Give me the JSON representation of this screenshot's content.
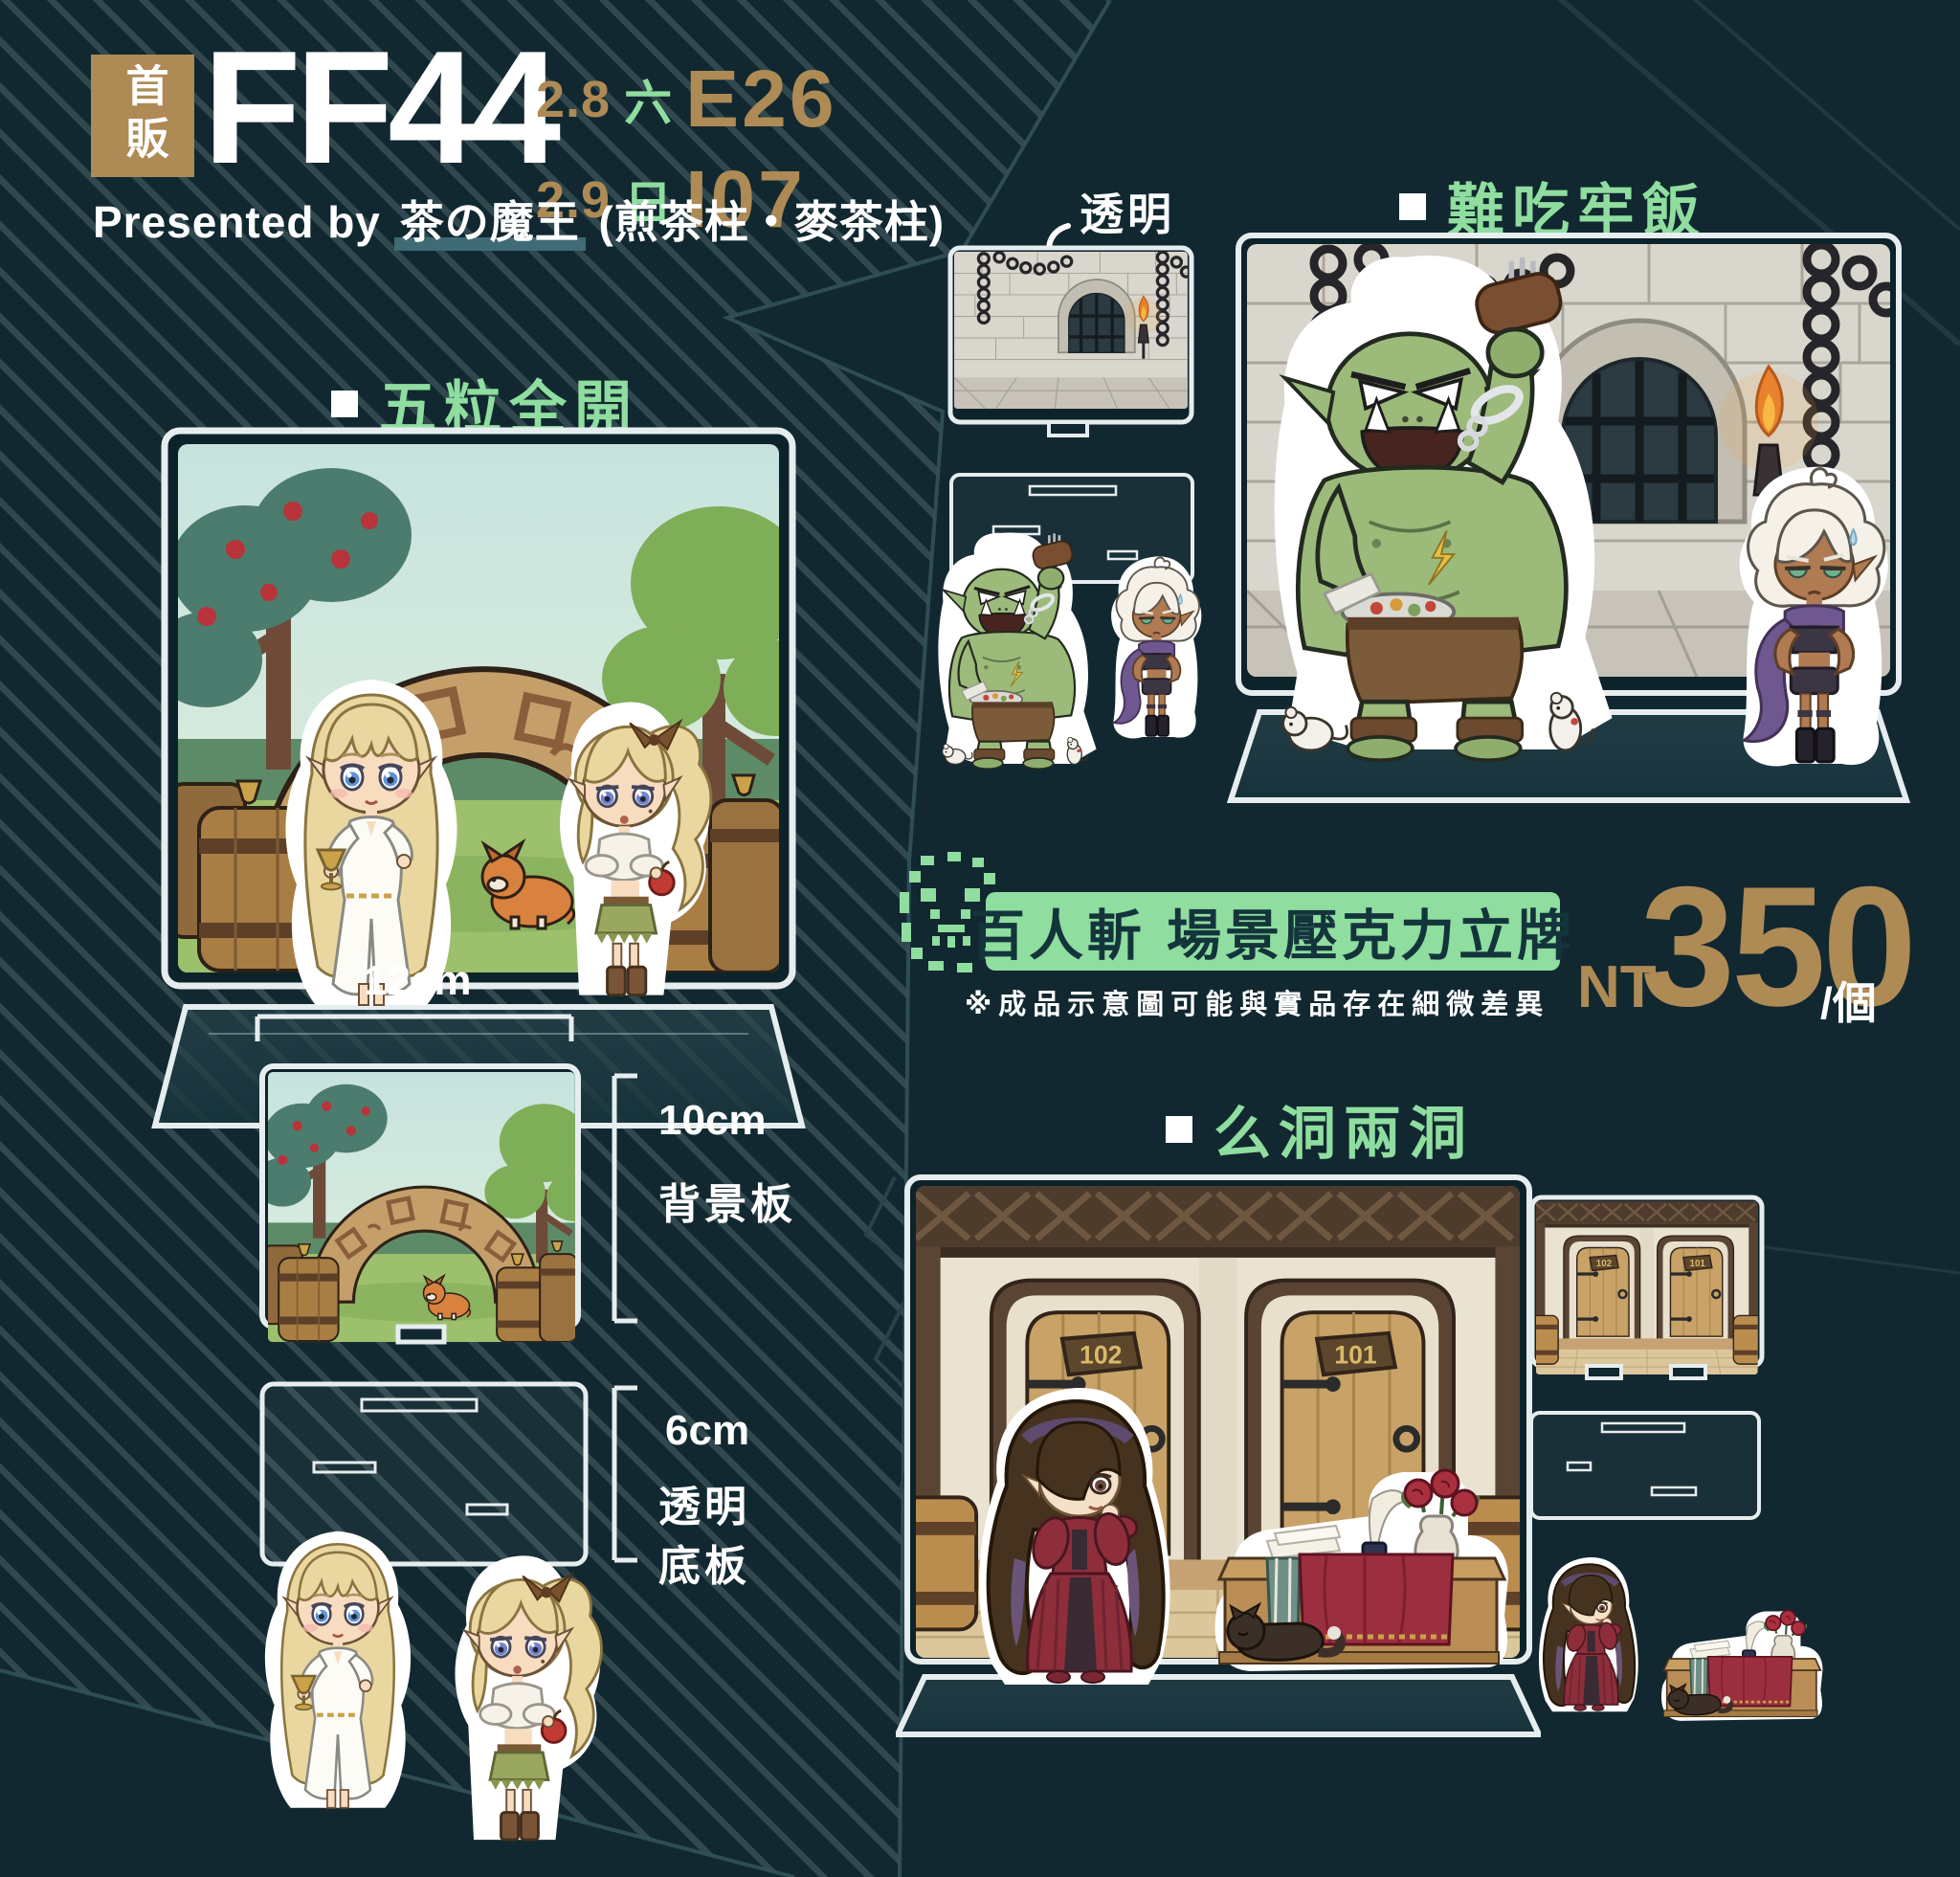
{
  "poster": {
    "badge": "首販",
    "event_code": "FF44",
    "schedule": [
      {
        "date": "2.8",
        "weekday": "六",
        "booth": "E26"
      },
      {
        "date": "2.9",
        "weekday": "日",
        "booth": "I07"
      }
    ],
    "presented_by_prefix": "Presented by",
    "circle_name": "茶の魔王",
    "presented_by_suffix": "(煎茶柱・麥茶柱)"
  },
  "products": {
    "garden": {
      "label": "五粒全開"
    },
    "prison": {
      "label": "難吃牢飯",
      "transparent_note": "透明"
    },
    "inn": {
      "label": "么洞兩洞",
      "door_sign_left": "102",
      "door_sign_right": "101"
    }
  },
  "size_guide": {
    "width": "12cm",
    "backdrop_height": "10cm",
    "backdrop_name": "背景板",
    "base_height": "6cm",
    "base_name_line1": "透明",
    "base_name_line2": "底板"
  },
  "pricing": {
    "series_name": "百人斬",
    "product_name": "場景壓克力立牌",
    "disclaimer": "※成品示意圖可能與實品存在細微差異",
    "currency": "NT",
    "amount": "350",
    "per_unit": "/個"
  },
  "colors": {
    "background": "#112830",
    "stripe": "#31484e",
    "gold": "#ae8a55",
    "green": "#8fdd9f",
    "pill_text": "#14343c",
    "white": "#ffffff"
  }
}
